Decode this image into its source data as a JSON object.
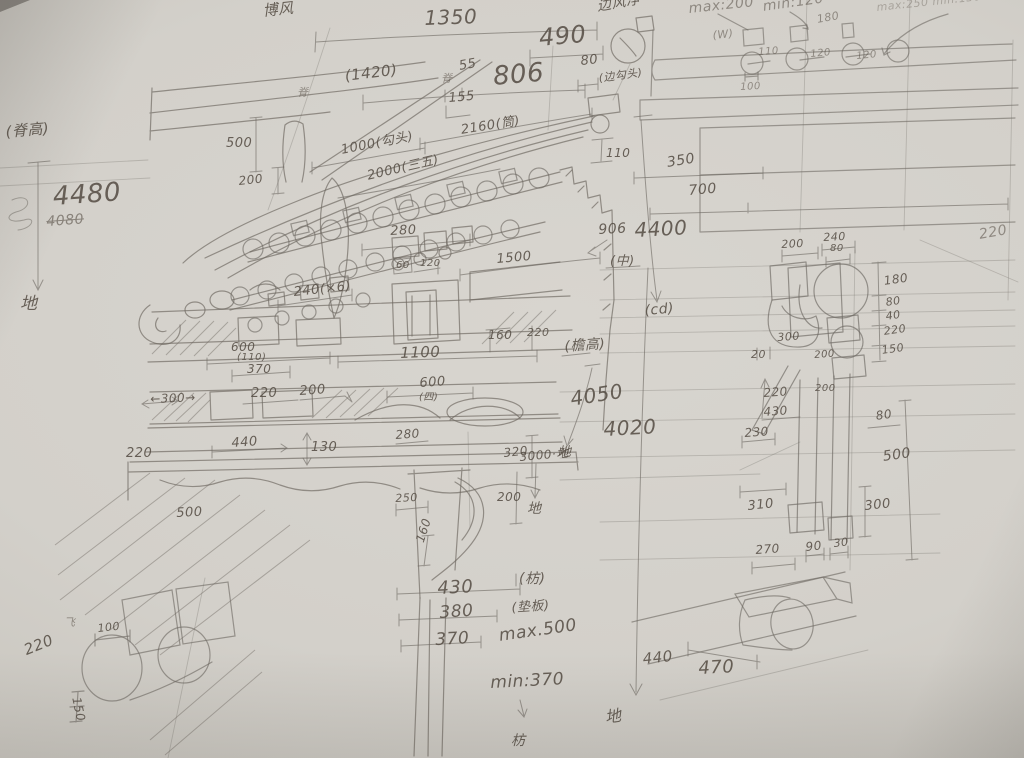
{
  "page": {
    "description_colors": {
      "paper": "#d3d0ca",
      "pencil": "#6e6962",
      "ink_text": "#574f46"
    }
  },
  "labels": [
    {
      "n": "label-bofeng",
      "t": "博风",
      "x": 262,
      "y": 4,
      "s": 15,
      "r": -6
    },
    {
      "n": "dim-1350",
      "t": "1350",
      "x": 424,
      "y": 8,
      "s": 20,
      "r": -2
    },
    {
      "n": "label-bianfengjing",
      "t": "边风净",
      "x": 596,
      "y": 0,
      "s": 14,
      "r": -10
    },
    {
      "n": "dim-max-200",
      "t": "max:200",
      "x": 688,
      "y": 2,
      "s": 14,
      "r": -6,
      "cl": "faint"
    },
    {
      "n": "dim-min-120",
      "t": "min:120",
      "x": 762,
      "y": 0,
      "s": 14,
      "r": -8,
      "cl": "faint"
    },
    {
      "n": "dim-max250-min130",
      "t": "max:250 min:130",
      "x": 876,
      "y": 2,
      "s": 11,
      "r": -6,
      "cl": "xfaint"
    },
    {
      "n": "dim-490",
      "t": "490",
      "x": 538,
      "y": 26,
      "s": 24,
      "r": -5
    },
    {
      "n": "dim-180-top",
      "t": "180",
      "x": 816,
      "y": 14,
      "s": 11,
      "r": -10,
      "cl": "faint"
    },
    {
      "n": "label-w-mark",
      "t": "(W)",
      "x": 712,
      "y": 30,
      "s": 11,
      "r": -6,
      "cl": "faint"
    },
    {
      "n": "dim-110-plan",
      "t": "110",
      "x": 758,
      "y": 48,
      "s": 10,
      "r": -4,
      "cl": "faint"
    },
    {
      "n": "dim-120-plan-a",
      "t": "120",
      "x": 810,
      "y": 50,
      "s": 10,
      "r": -5,
      "cl": "faint"
    },
    {
      "n": "dim-120-plan-b",
      "t": "120",
      "x": 856,
      "y": 52,
      "s": 10,
      "r": -5,
      "cl": "faint"
    },
    {
      "n": "dim-100-plan",
      "t": "100",
      "x": 740,
      "y": 83,
      "s": 10,
      "r": -3,
      "cl": "faint"
    },
    {
      "n": "dim-80-top",
      "t": "80",
      "x": 580,
      "y": 55,
      "s": 13,
      "r": -6
    },
    {
      "n": "char-ji-a",
      "t": "脊",
      "x": 297,
      "y": 87,
      "s": 11,
      "r": 0,
      "cl": "faint"
    },
    {
      "n": "dim-1420",
      "t": "(1420)",
      "x": 344,
      "y": 69,
      "s": 15,
      "r": -7
    },
    {
      "n": "char-ji-b",
      "t": "脊",
      "x": 441,
      "y": 73,
      "s": 11,
      "r": 0,
      "cl": "faint"
    },
    {
      "n": "dim-55",
      "t": "55",
      "x": 458,
      "y": 60,
      "s": 13,
      "r": -10
    },
    {
      "n": "dim-806",
      "t": "806",
      "x": 492,
      "y": 64,
      "s": 26,
      "r": -5
    },
    {
      "n": "dim-155",
      "t": "155",
      "x": 448,
      "y": 92,
      "s": 13,
      "r": -5
    },
    {
      "n": "label-bian-goutou",
      "t": "(边勾头)",
      "x": 598,
      "y": 73,
      "s": 11,
      "r": -8
    },
    {
      "n": "dim-2160-tong",
      "t": "2160(筒)",
      "x": 460,
      "y": 124,
      "s": 13,
      "r": -9
    },
    {
      "n": "dim-1000-goutou",
      "t": "1000(勾头)",
      "x": 340,
      "y": 144,
      "s": 13,
      "r": -11
    },
    {
      "n": "dim-2000",
      "t": "2000(三五)",
      "x": 366,
      "y": 170,
      "s": 13,
      "r": -13
    },
    {
      "n": "dim-500-v",
      "t": "500",
      "x": 226,
      "y": 137,
      "s": 13,
      "r": 0
    },
    {
      "n": "dim-200-v",
      "t": "200",
      "x": 238,
      "y": 175,
      "s": 12,
      "r": -6
    },
    {
      "n": "dim-110-ibar",
      "t": "110",
      "x": 606,
      "y": 147,
      "s": 12,
      "r": 0
    },
    {
      "n": "dim-350",
      "t": "350",
      "x": 666,
      "y": 156,
      "s": 14,
      "r": -9
    },
    {
      "n": "dim-700",
      "t": "700",
      "x": 688,
      "y": 184,
      "s": 14,
      "r": -5
    },
    {
      "n": "dim-906",
      "t": "906",
      "x": 598,
      "y": 223,
      "s": 14,
      "r": -3
    },
    {
      "n": "dim-4400",
      "t": "4400",
      "x": 634,
      "y": 220,
      "s": 20,
      "r": -3
    },
    {
      "n": "label-center-mark",
      "t": "(中)",
      "x": 610,
      "y": 255,
      "s": 13,
      "r": 0
    },
    {
      "n": "label-cd",
      "t": "(cd)",
      "x": 644,
      "y": 304,
      "s": 14,
      "r": -5
    },
    {
      "n": "dim-220-far-right",
      "t": "220",
      "x": 978,
      "y": 228,
      "s": 14,
      "r": -10,
      "cl": "faint"
    },
    {
      "n": "dim-280-a",
      "t": "280",
      "x": 390,
      "y": 225,
      "s": 13,
      "r": -3
    },
    {
      "n": "dim-1500",
      "t": "1500",
      "x": 496,
      "y": 253,
      "s": 13,
      "r": -5
    },
    {
      "n": "dim-240x6",
      "t": "240(×6)",
      "x": 293,
      "y": 286,
      "s": 13,
      "r": -6
    },
    {
      "n": "dim-60-small",
      "t": "60",
      "x": 396,
      "y": 261,
      "s": 10,
      "r": 0
    },
    {
      "n": "dim-120-small",
      "t": "120",
      "x": 420,
      "y": 259,
      "s": 10,
      "r": 0
    },
    {
      "n": "dim-160-small",
      "t": "160",
      "x": 488,
      "y": 329,
      "s": 12,
      "r": 0
    },
    {
      "n": "dim-220-small",
      "t": "220",
      "x": 527,
      "y": 327,
      "s": 11,
      "r": 0
    },
    {
      "n": "dim-600-a",
      "t": "600",
      "x": 231,
      "y": 341,
      "s": 12,
      "r": 0
    },
    {
      "n": "dim-110-paren",
      "t": "(110)",
      "x": 237,
      "y": 353,
      "s": 10,
      "r": 0
    },
    {
      "n": "dim-370-a",
      "t": "370",
      "x": 247,
      "y": 363,
      "s": 12,
      "r": 0
    },
    {
      "n": "dim-1100",
      "t": "1100",
      "x": 400,
      "y": 346,
      "s": 15,
      "r": -2
    },
    {
      "n": "dim-300-arrows",
      "t": "←300→",
      "x": 150,
      "y": 393,
      "s": 12,
      "r": -2
    },
    {
      "n": "dim-220-b",
      "t": "220",
      "x": 251,
      "y": 387,
      "s": 13,
      "r": 0
    },
    {
      "n": "dim-200-b",
      "t": "200",
      "x": 299,
      "y": 385,
      "s": 13,
      "r": -4
    },
    {
      "n": "dim-600-b",
      "t": "600",
      "x": 419,
      "y": 377,
      "s": 13,
      "r": -4
    },
    {
      "n": "label-si-mark",
      "t": "(四)",
      "x": 419,
      "y": 393,
      "s": 10,
      "r": 0
    },
    {
      "n": "dim-440",
      "t": "440",
      "x": 231,
      "y": 437,
      "s": 13,
      "r": -4
    },
    {
      "n": "dim-130",
      "t": "130",
      "x": 311,
      "y": 441,
      "s": 13,
      "r": 0
    },
    {
      "n": "dim-280-b",
      "t": "280",
      "x": 395,
      "y": 429,
      "s": 12,
      "r": -4
    },
    {
      "n": "dim-320",
      "t": "320",
      "x": 503,
      "y": 447,
      "s": 12,
      "r": -6
    },
    {
      "n": "dim-3000-ground",
      "t": "3000·地",
      "x": 519,
      "y": 451,
      "s": 12,
      "r": -5
    },
    {
      "n": "dim-220-left",
      "t": "220",
      "x": 126,
      "y": 447,
      "s": 13,
      "r": 0
    },
    {
      "n": "dim-500-left",
      "t": "500",
      "x": 176,
      "y": 507,
      "s": 13,
      "r": -3
    },
    {
      "n": "dim-250",
      "t": "250",
      "x": 395,
      "y": 493,
      "s": 11,
      "r": -3
    },
    {
      "n": "dim-200-c",
      "t": "200",
      "x": 497,
      "y": 491,
      "s": 12,
      "r": 0
    },
    {
      "n": "label-ground-c",
      "t": "地",
      "x": 527,
      "y": 502,
      "s": 14,
      "r": 0
    },
    {
      "n": "dim-160-rot",
      "t": "160",
      "x": 414,
      "y": 540,
      "s": 12,
      "r": -72
    },
    {
      "n": "dim-430-col",
      "t": "430",
      "x": 437,
      "y": 580,
      "s": 18,
      "r": -3
    },
    {
      "n": "label-fang",
      "t": "(枋)",
      "x": 519,
      "y": 572,
      "s": 14,
      "r": 0
    },
    {
      "n": "dim-380-col",
      "t": "380",
      "x": 439,
      "y": 605,
      "s": 17,
      "r": -4
    },
    {
      "n": "label-dianban",
      "t": "(垫板)",
      "x": 511,
      "y": 602,
      "s": 13,
      "r": -4
    },
    {
      "n": "dim-370-col",
      "t": "370",
      "x": 435,
      "y": 632,
      "s": 17,
      "r": -3
    },
    {
      "n": "dim-max-500",
      "t": "max.500",
      "x": 498,
      "y": 628,
      "s": 17,
      "r": -8
    },
    {
      "n": "dim-min-370",
      "t": "min:370",
      "x": 490,
      "y": 675,
      "s": 17,
      "r": -3
    },
    {
      "n": "label-fang-bottom",
      "t": "枋",
      "x": 511,
      "y": 734,
      "s": 14,
      "r": 0
    },
    {
      "n": "label-ground-d",
      "t": "地",
      "x": 604,
      "y": 710,
      "s": 16,
      "r": -8
    },
    {
      "n": "dim-4050",
      "t": "4050",
      "x": 569,
      "y": 389,
      "s": 20,
      "r": -9
    },
    {
      "n": "dim-4020",
      "t": "4020",
      "x": 603,
      "y": 419,
      "s": 20,
      "r": -3
    },
    {
      "n": "label-ground-e",
      "t": "地",
      "x": 558,
      "y": 446,
      "s": 13,
      "r": 0
    },
    {
      "n": "label-yangao",
      "t": "(檐高)",
      "x": 564,
      "y": 340,
      "s": 14,
      "r": -4
    },
    {
      "n": "label-jigao",
      "t": "(脊高)",
      "x": 5,
      "y": 125,
      "s": 15,
      "r": -5
    },
    {
      "n": "dim-4480",
      "t": "4480",
      "x": 52,
      "y": 184,
      "s": 26,
      "r": -4
    },
    {
      "n": "dim-4080-struck",
      "t": "4080",
      "x": 46,
      "y": 215,
      "s": 14,
      "r": -4,
      "cl": "strike"
    },
    {
      "n": "label-ground-a",
      "t": "地",
      "x": 20,
      "y": 296,
      "s": 17,
      "r": 0
    },
    {
      "n": "dim-200-d",
      "t": "200",
      "x": 781,
      "y": 239,
      "s": 11,
      "r": -3
    },
    {
      "n": "dim-240-d",
      "t": "240",
      "x": 823,
      "y": 232,
      "s": 11,
      "r": -3
    },
    {
      "n": "dim-80-d",
      "t": "80",
      "x": 830,
      "y": 244,
      "s": 10,
      "r": 0
    },
    {
      "n": "dim-180-d",
      "t": "180",
      "x": 883,
      "y": 275,
      "s": 12,
      "r": -8
    },
    {
      "n": "dim-80-e",
      "t": "80",
      "x": 885,
      "y": 297,
      "s": 11,
      "r": -8
    },
    {
      "n": "dim-40-d",
      "t": "40",
      "x": 885,
      "y": 311,
      "s": 11,
      "r": -8
    },
    {
      "n": "dim-220-d",
      "t": "220",
      "x": 883,
      "y": 326,
      "s": 11,
      "r": -8
    },
    {
      "n": "dim-150-d",
      "t": "150",
      "x": 881,
      "y": 345,
      "s": 11,
      "r": -8
    },
    {
      "n": "dim-300-d",
      "t": "300",
      "x": 777,
      "y": 332,
      "s": 11,
      "r": -4
    },
    {
      "n": "dim-20-d",
      "t": "20",
      "x": 751,
      "y": 349,
      "s": 11,
      "r": 0
    },
    {
      "n": "dim-200-e",
      "t": "200",
      "x": 814,
      "y": 351,
      "s": 10,
      "r": -4
    },
    {
      "n": "dim-220-e",
      "t": "220",
      "x": 763,
      "y": 387,
      "s": 12,
      "r": -4
    },
    {
      "n": "dim-430-d",
      "t": "430",
      "x": 763,
      "y": 406,
      "s": 12,
      "r": -4
    },
    {
      "n": "dim-230-d",
      "t": "230",
      "x": 744,
      "y": 427,
      "s": 12,
      "r": -4
    },
    {
      "n": "dim-200-f",
      "t": "200",
      "x": 815,
      "y": 384,
      "s": 10,
      "r": 0
    },
    {
      "n": "dim-80-f",
      "t": "80",
      "x": 875,
      "y": 410,
      "s": 12,
      "r": -8
    },
    {
      "n": "dim-500-d",
      "t": "500",
      "x": 882,
      "y": 450,
      "s": 14,
      "r": -8
    },
    {
      "n": "dim-310-d",
      "t": "310",
      "x": 747,
      "y": 500,
      "s": 13,
      "r": -6
    },
    {
      "n": "dim-300-e",
      "t": "300",
      "x": 864,
      "y": 500,
      "s": 13,
      "r": -6
    },
    {
      "n": "dim-270-d",
      "t": "270",
      "x": 755,
      "y": 544,
      "s": 12,
      "r": -4
    },
    {
      "n": "dim-90-d",
      "t": "90",
      "x": 805,
      "y": 541,
      "s": 12,
      "r": -6
    },
    {
      "n": "dim-30-d",
      "t": "30",
      "x": 833,
      "y": 538,
      "s": 11,
      "r": -6
    },
    {
      "n": "dim-440-b",
      "t": "440",
      "x": 642,
      "y": 652,
      "s": 15,
      "r": -6
    },
    {
      "n": "dim-470-b",
      "t": "470",
      "x": 698,
      "y": 660,
      "s": 18,
      "r": -3
    },
    {
      "n": "dim-220-bl",
      "t": "220",
      "x": 22,
      "y": 644,
      "s": 15,
      "r": -22
    },
    {
      "n": "dim-100-bl",
      "t": "100",
      "x": 97,
      "y": 623,
      "s": 11,
      "r": -6
    },
    {
      "n": "char-fei",
      "t": "飞",
      "x": 64,
      "y": 617,
      "s": 11,
      "r": 0,
      "cl": "faint"
    },
    {
      "n": "dim-150-bl",
      "t": "150",
      "x": 82,
      "y": 696,
      "s": 12,
      "r": 78
    }
  ]
}
